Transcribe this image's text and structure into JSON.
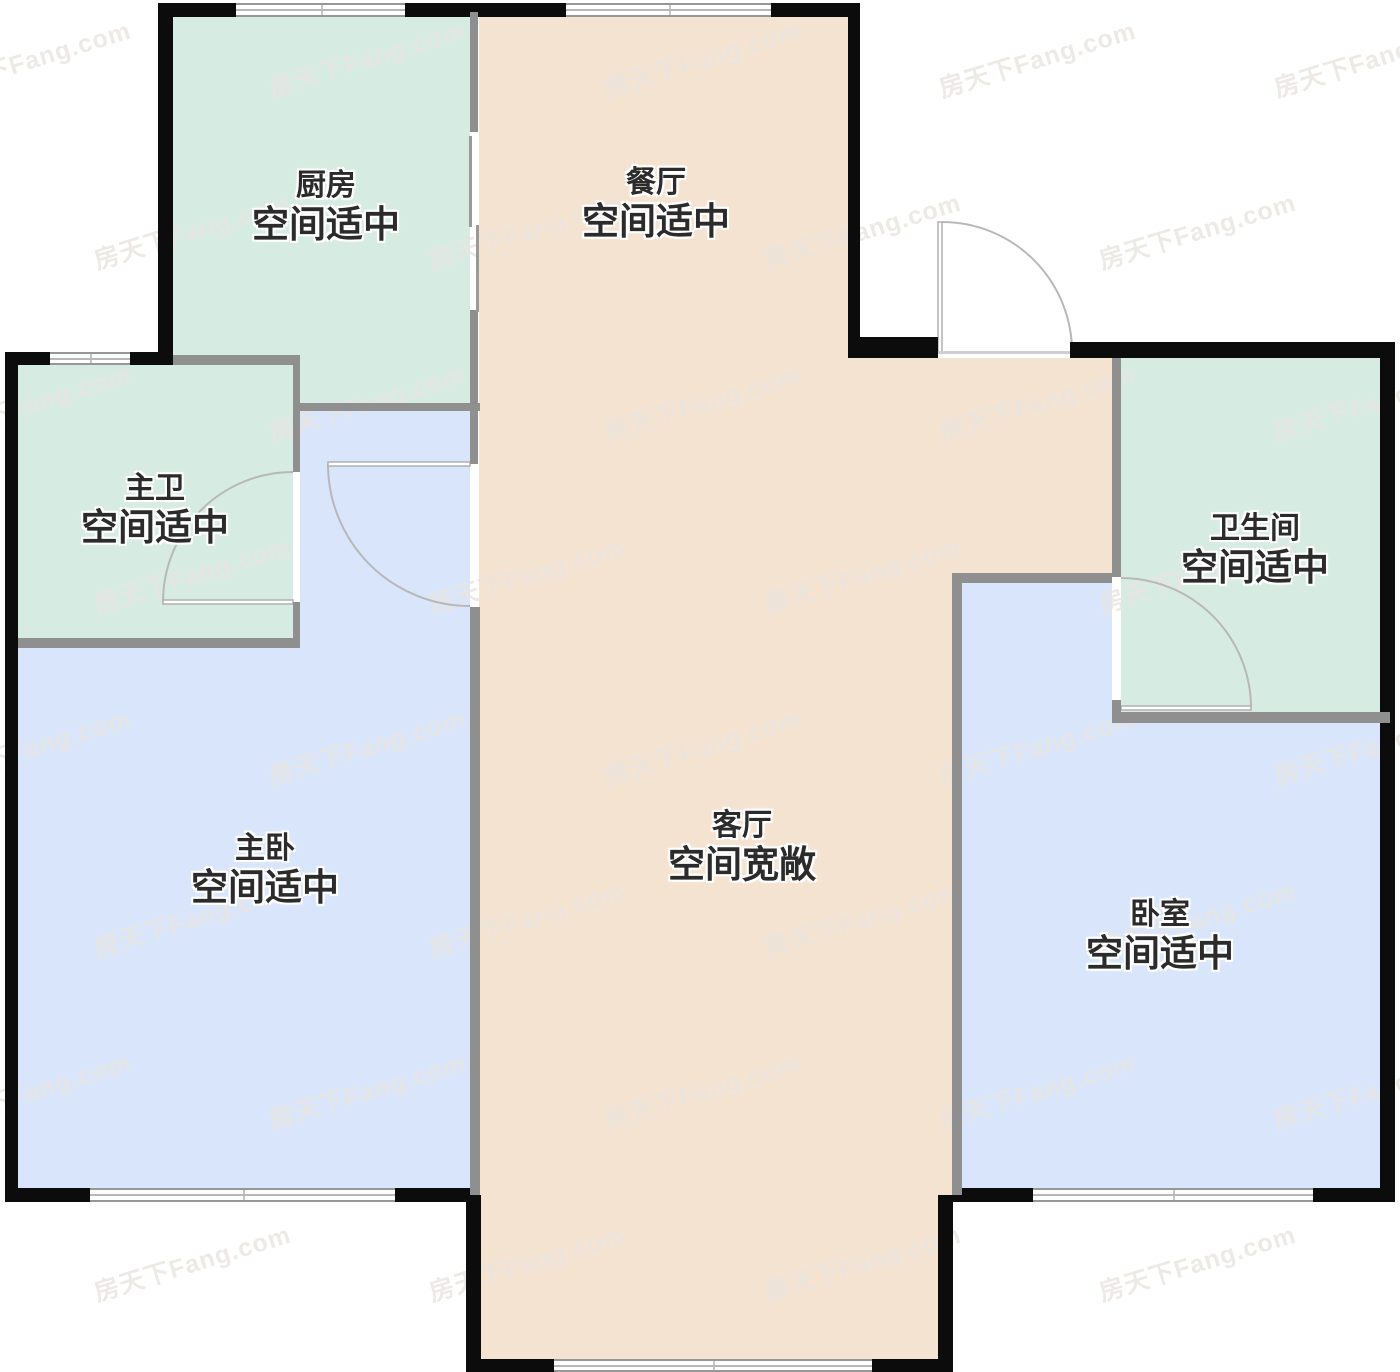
{
  "page": {
    "title": "户型图",
    "background": "#ffffff"
  },
  "watermark": {
    "text": "房天下Fang.com"
  },
  "palette": {
    "exterior_wall": "#0c0c0c",
    "interior_wall": "#8f8f8f",
    "kitchen_bath_fill": "#d6ebe2",
    "living_dining_fill": "#f5e3d1",
    "bedroom_fill": "#d9e5fa",
    "door_line": "#b8b8b8",
    "window_line": "#979797",
    "label_color": "#2b2b2b"
  },
  "rooms": [
    {
      "id": "kitchen",
      "name": "厨房",
      "status": "空间适中"
    },
    {
      "id": "dining",
      "name": "餐厅",
      "status": "空间适中"
    },
    {
      "id": "master-bath",
      "name": "主卫",
      "status": "空间适中"
    },
    {
      "id": "bathroom",
      "name": "卫生间",
      "status": "空间适中"
    },
    {
      "id": "master-bedroom",
      "name": "主卧",
      "status": "空间适中"
    },
    {
      "id": "living",
      "name": "客厅",
      "status": "空间宽敞"
    },
    {
      "id": "bedroom",
      "name": "卧室",
      "status": "空间适中"
    }
  ]
}
